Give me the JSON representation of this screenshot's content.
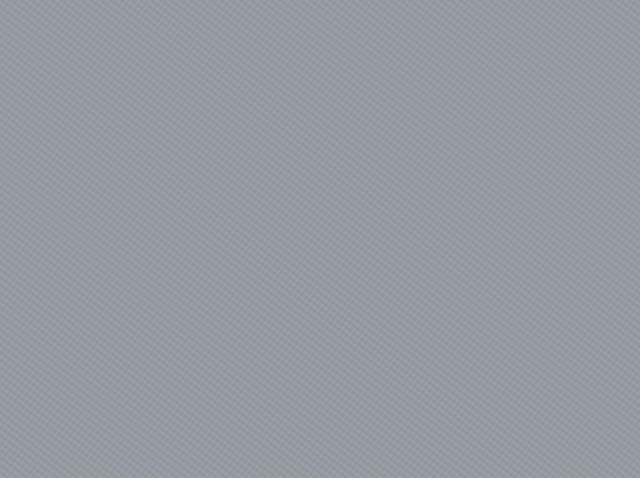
{
  "map": {
    "title": "Aerial cadastral parcel map",
    "labels": [
      {
        "id": "804",
        "text": "804"
      },
      {
        "id": "768-16",
        "text": "768-16"
      },
      {
        "id": "768",
        "text": "768"
      },
      {
        "id": "768-11",
        "text": "768-11"
      },
      {
        "id": "802-29",
        "text": "802-29"
      },
      {
        "id": "-27",
        "text": "-27"
      },
      {
        "id": "802-30",
        "text": "802-30"
      },
      {
        "id": "802-48",
        "text": "802-48"
      },
      {
        "id": "802-49",
        "text": "802-49"
      },
      {
        "id": "802-50",
        "text": "802-50"
      },
      {
        "id": "802-47",
        "text": "802 47"
      },
      {
        "id": "802-46",
        "text": "802-46"
      },
      {
        "id": "802-45",
        "text": "802-45"
      },
      {
        "id": "802-31",
        "text": "802-31"
      },
      {
        "id": "80",
        "text": "80"
      }
    ],
    "colors": {
      "boundary_line": "#2b4a78",
      "building_outline": "#17191d",
      "label_text": "#35383c",
      "vegetation": "#55624c",
      "road": "#9aa0a5",
      "building_light": "#eef0f1",
      "building_gray": "#c7cbce",
      "rust_roof": "#8d5348",
      "red_car": "#9a4136",
      "shadow_area": "#5f6d84"
    }
  }
}
